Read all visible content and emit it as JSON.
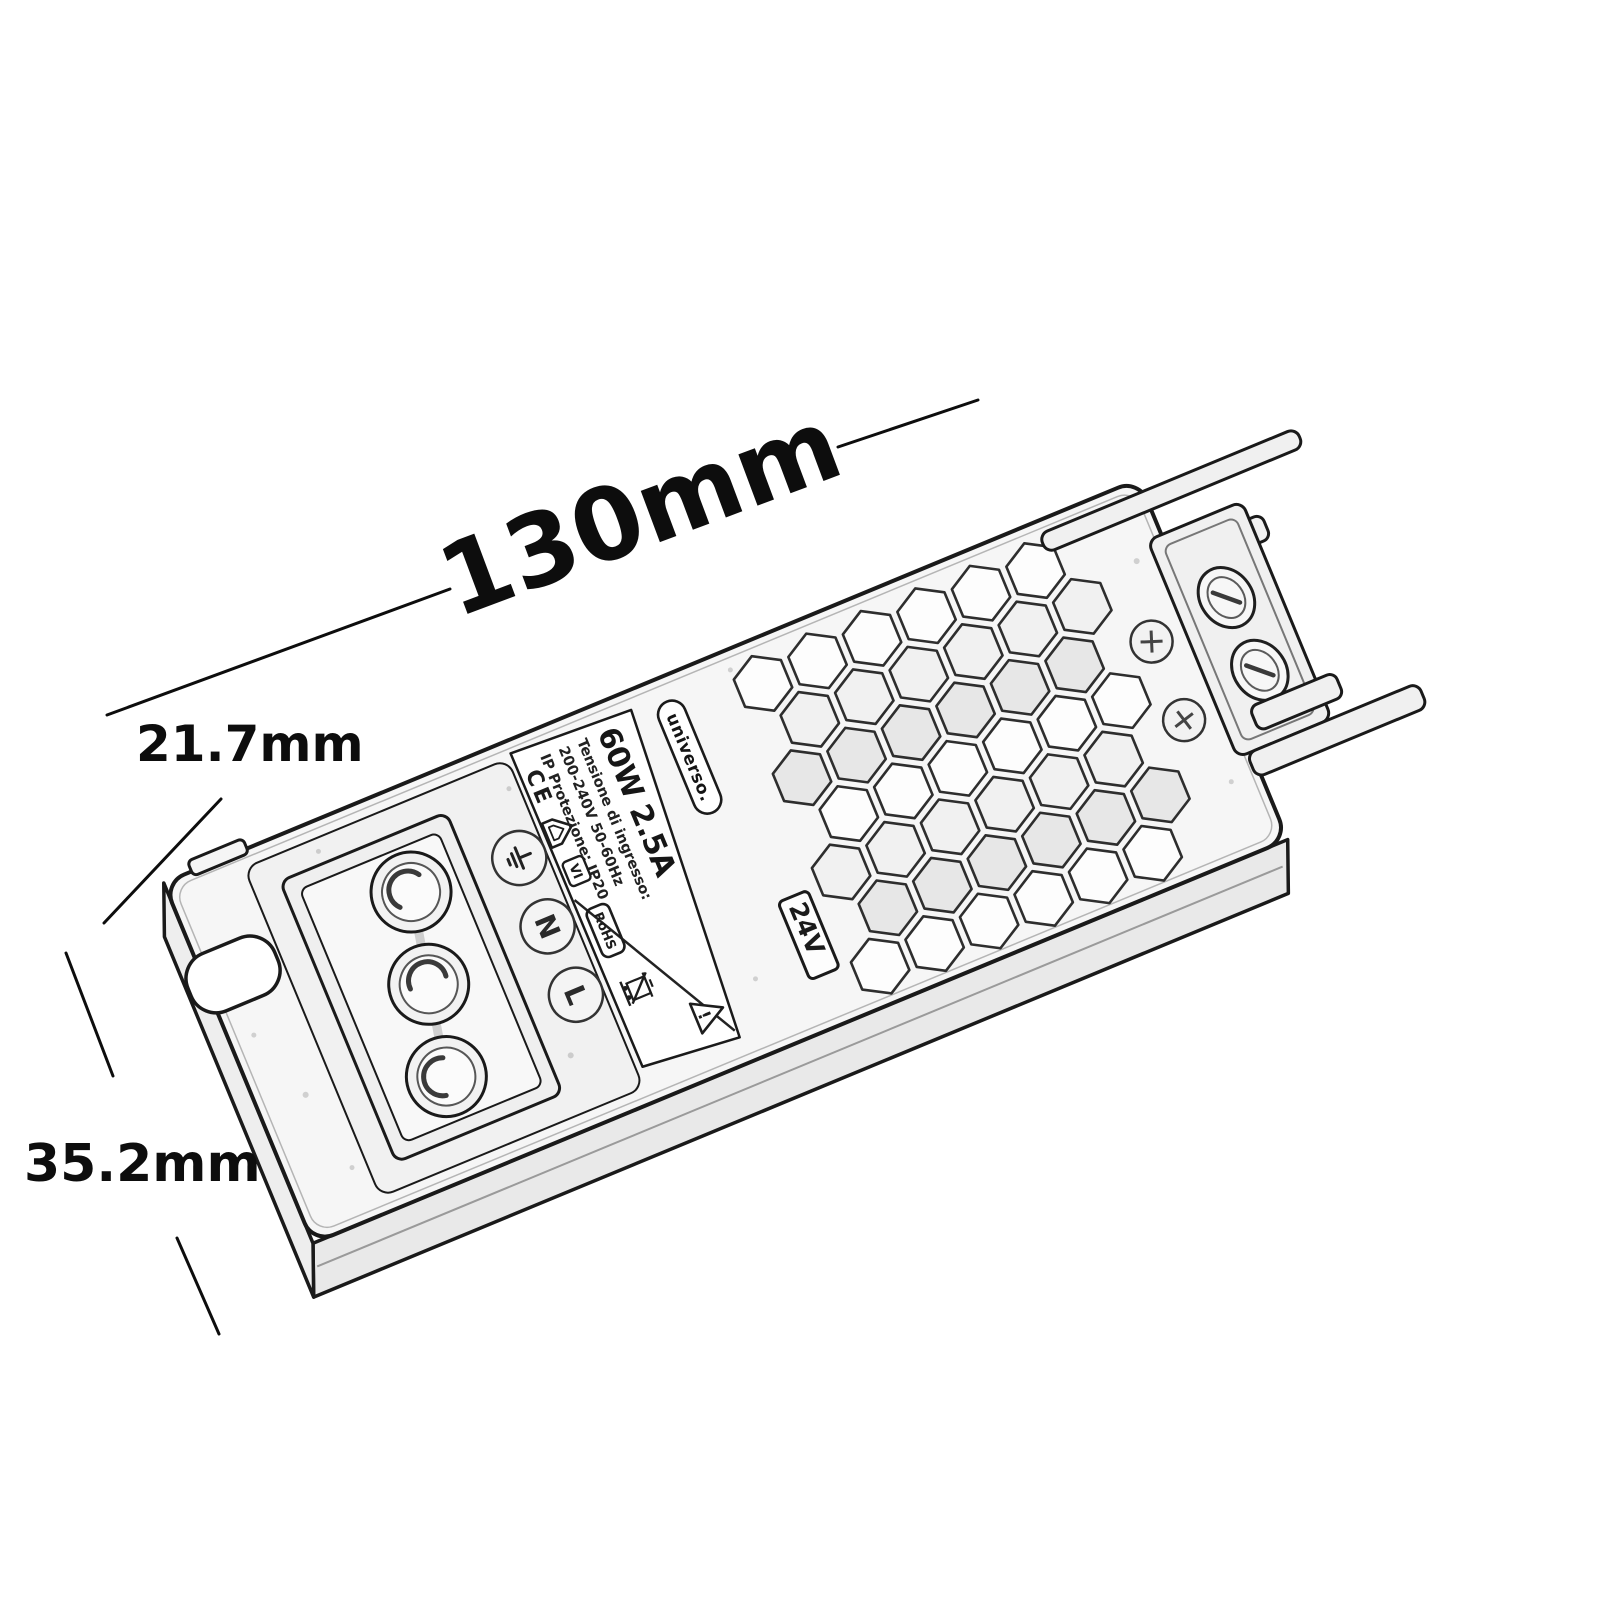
{
  "figure": {
    "kind": "product dimension sketch",
    "subject": "slim LED driver power supply, outline sketch with honeycomb vent grille"
  },
  "dimensions": {
    "length": {
      "label": "130mm"
    },
    "depth": {
      "label": "21.7mm"
    },
    "width": {
      "label": "35.2mm"
    }
  },
  "device": {
    "brand": "universo.",
    "rating": "60W 2.5A",
    "input_label": "Tensione di ingresso:",
    "input_value": "200-240V 50-60Hz",
    "ip_rating": "IP Protezione: IP20",
    "output_voltage": "24V",
    "ce_mark": "CE",
    "efficiency_badge": "VI",
    "rohs_badge": "RoHS",
    "warning_mark": "!",
    "terminals": {
      "earth": "earth-ground-symbol",
      "neutral": "N",
      "live": "L"
    }
  },
  "icons": [
    "earth-ground-icon",
    "ce-mark",
    "indoor-use-house-icon",
    "efficiency-vi-badge",
    "rohs-badge",
    "weee-crossed-bin-icon",
    "warning-triangle-icon"
  ],
  "colors": {
    "ink": "#0d0d0d",
    "line": "#1a1a1a",
    "mid": "#666666",
    "soft": "#9b9b9b",
    "fillA": "#f5f5f5",
    "fillB": "#ececec",
    "paper": "#ffffff"
  }
}
